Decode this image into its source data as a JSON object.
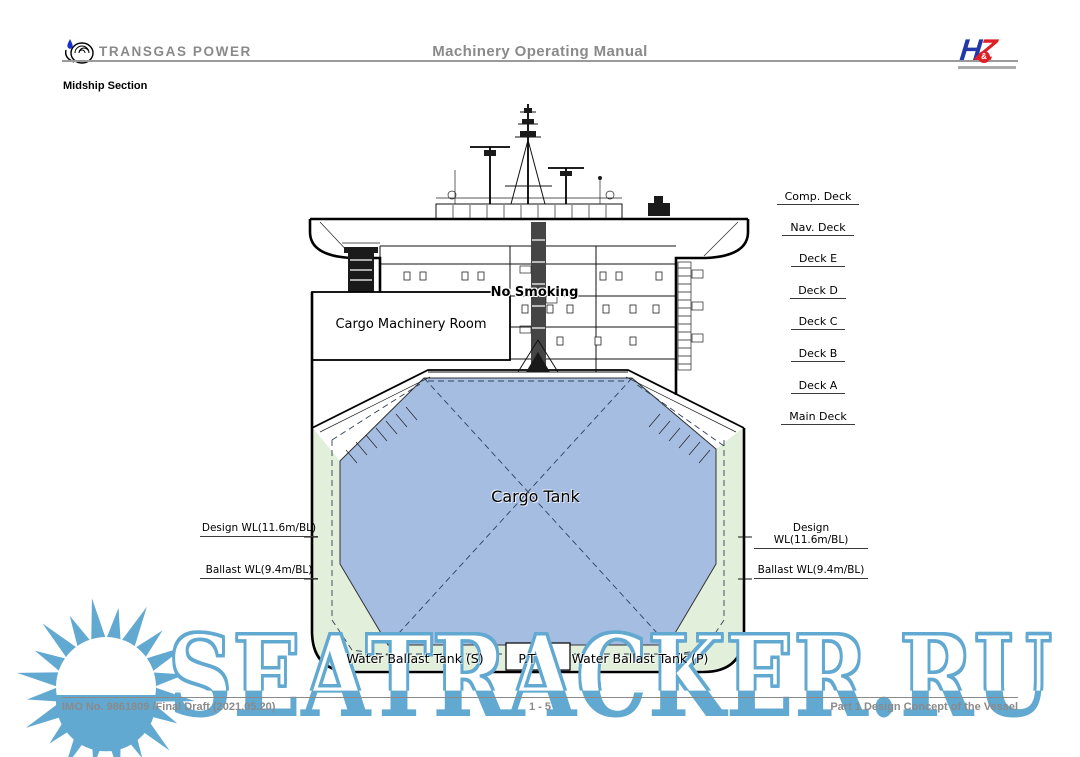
{
  "header": {
    "company": "TRANSGAS POWER",
    "title": "Machinery Operating Manual",
    "logo_h": "H",
    "logo_z": "Z",
    "logo_amp": "&"
  },
  "section_label": "Midship Section",
  "diagram": {
    "deck_labels": [
      "Comp. Deck",
      "Nav. Deck",
      "Deck E",
      "Deck D",
      "Deck C",
      "Deck B",
      "Deck A",
      "Main Deck"
    ],
    "waterline_labels": {
      "design": "Design WL(11.6m/BL)",
      "ballast": "Ballast WL(9.4m/BL)"
    },
    "no_smoking": "No Smoking",
    "cargo_machinery_room": "Cargo Machinery Room",
    "cargo_tank": "Cargo Tank",
    "water_ballast_s": "Water Ballast Tank (S)",
    "pipe_trunk": "P.T",
    "water_ballast_p": "Water Ballast Tank (P)",
    "colors": {
      "tank_blue": "#a6bde2",
      "ballast_green": "#e2efdb"
    }
  },
  "watermark": {
    "text": "SEATRACKER.RU",
    "color": "#62a9d2"
  },
  "footer": {
    "left": "IMO No. 9861809 /Final Draft (2021.05.20)",
    "center": "1 - 5",
    "right": "Part 1 Design Concept of the Vessel"
  }
}
